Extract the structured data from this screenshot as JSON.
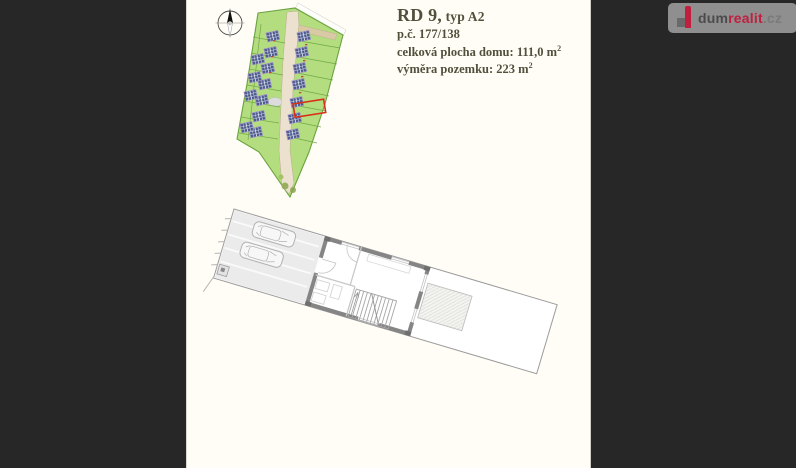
{
  "viewer": {
    "background_color": "#272727"
  },
  "sheet": {
    "background_color": "#fffdf6"
  },
  "property_info": {
    "title_main": "RD 9,",
    "title_type": " typ A2",
    "parcel_number": "p.č. 177/138",
    "house_area_label": "celková plocha domu: ",
    "house_area_value": "111,0 m",
    "house_area_exponent": "2",
    "plot_area_label": "výměra pozemku: ",
    "plot_area_value": "223 m",
    "plot_area_exponent": "2",
    "text_color": "#51503c"
  },
  "watermark": {
    "brand_prefix": "dum",
    "brand_highlight": "realit",
    "brand_suffix": ".cz",
    "badge_color": "#8f8f8f",
    "prefix_color": "#4b4b4b",
    "highlight_color": "#c01f3e",
    "suffix_color": "#7a7a7a",
    "icon": "dumrealit-house-icon"
  },
  "site_plan": {
    "compass_icon": "compass-north-icon",
    "plot_fill_color": "#b4dd80",
    "plot_line_color": "#69a33e",
    "roof_color": "#4d5c8f",
    "roof_frame_color": "#9a8cc4",
    "road_color": "#ece1cf",
    "entry_road_color": "#d9c9a4",
    "highlight_color": "#d83018"
  },
  "floor_plan": {
    "wall_color": "#858585",
    "outline_color": "#9c9c9c",
    "paving_color": "#ebebeb",
    "terrace_color": "#f4f4f0"
  }
}
